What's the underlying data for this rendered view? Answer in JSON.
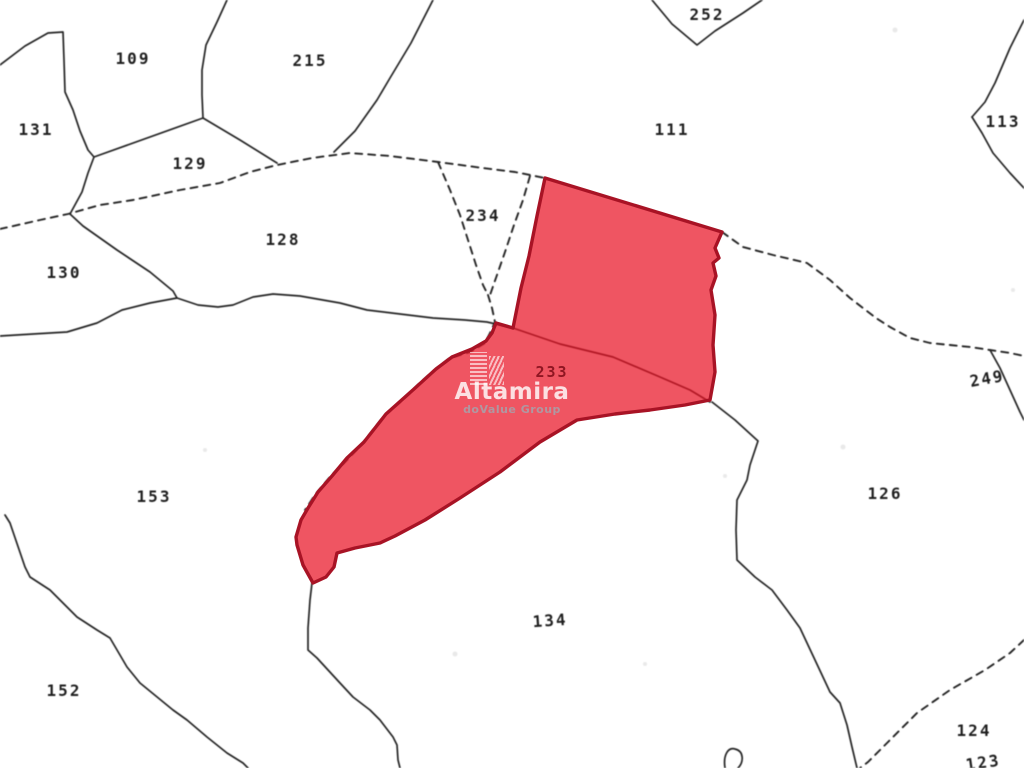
{
  "map": {
    "background_color": "#ffffff",
    "line_color": "#242424",
    "watermark": {
      "brand": "Altamira",
      "subtitle": "doValue Group",
      "logo_icon": "building-towers-icon"
    },
    "highlighted_parcel": {
      "id": "233",
      "fill_color": "#ee4d58",
      "border_color": "#a81325"
    },
    "parcel_labels": [
      {
        "id": "109"
      },
      {
        "id": "215"
      },
      {
        "id": "252"
      },
      {
        "id": "131"
      },
      {
        "id": "129"
      },
      {
        "id": "111"
      },
      {
        "id": "113"
      },
      {
        "id": "128"
      },
      {
        "id": "234"
      },
      {
        "id": "130"
      },
      {
        "id": "249"
      },
      {
        "id": "153"
      },
      {
        "id": "126"
      },
      {
        "id": "134"
      },
      {
        "id": "152"
      },
      {
        "id": "124"
      },
      {
        "id": "123"
      }
    ]
  }
}
